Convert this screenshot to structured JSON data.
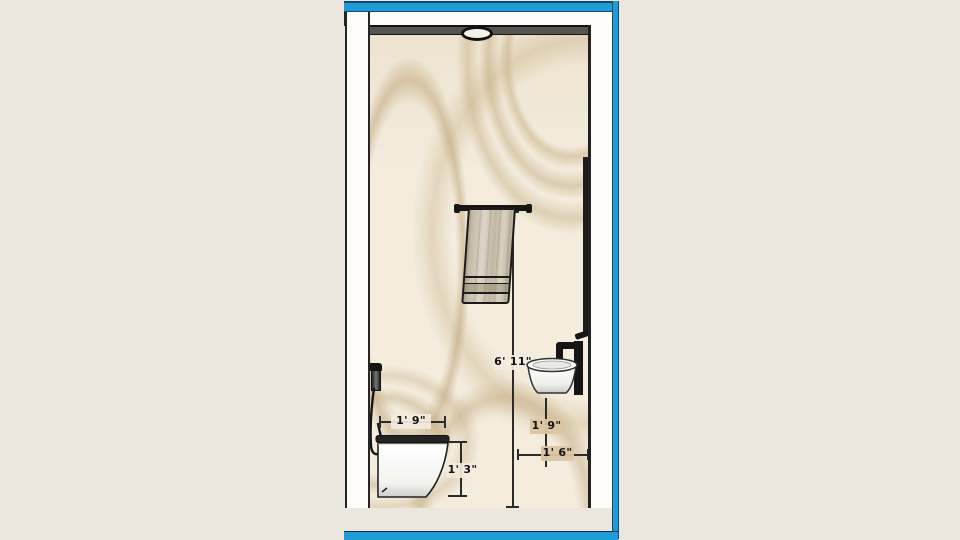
{
  "app": {
    "viewport_kind": "3d-elevation-viewport"
  },
  "colors": {
    "background": "#ece7de",
    "frame_cyan": "#1f9bd7",
    "frame_dark": "#17496b",
    "wall_base": "#f4edde",
    "wall_vein_tan": "#c9b288",
    "wall_top_band": "#56544f",
    "side_wall_white": "#fdfcf8",
    "floor_marble": "#f1ece0",
    "vanity_tan": "#d9c2a0",
    "towel_beige": "#cdc4b0",
    "fixture_black": "#161614",
    "dimension_text": "#111111"
  },
  "dimensions": {
    "toilet_depth": "1' 9\"",
    "toilet_height": "1' 3\"",
    "towel_bar_height": "6' 11\"",
    "vanity_height": "1' 9\"",
    "vanity_width": "1' 6\""
  }
}
